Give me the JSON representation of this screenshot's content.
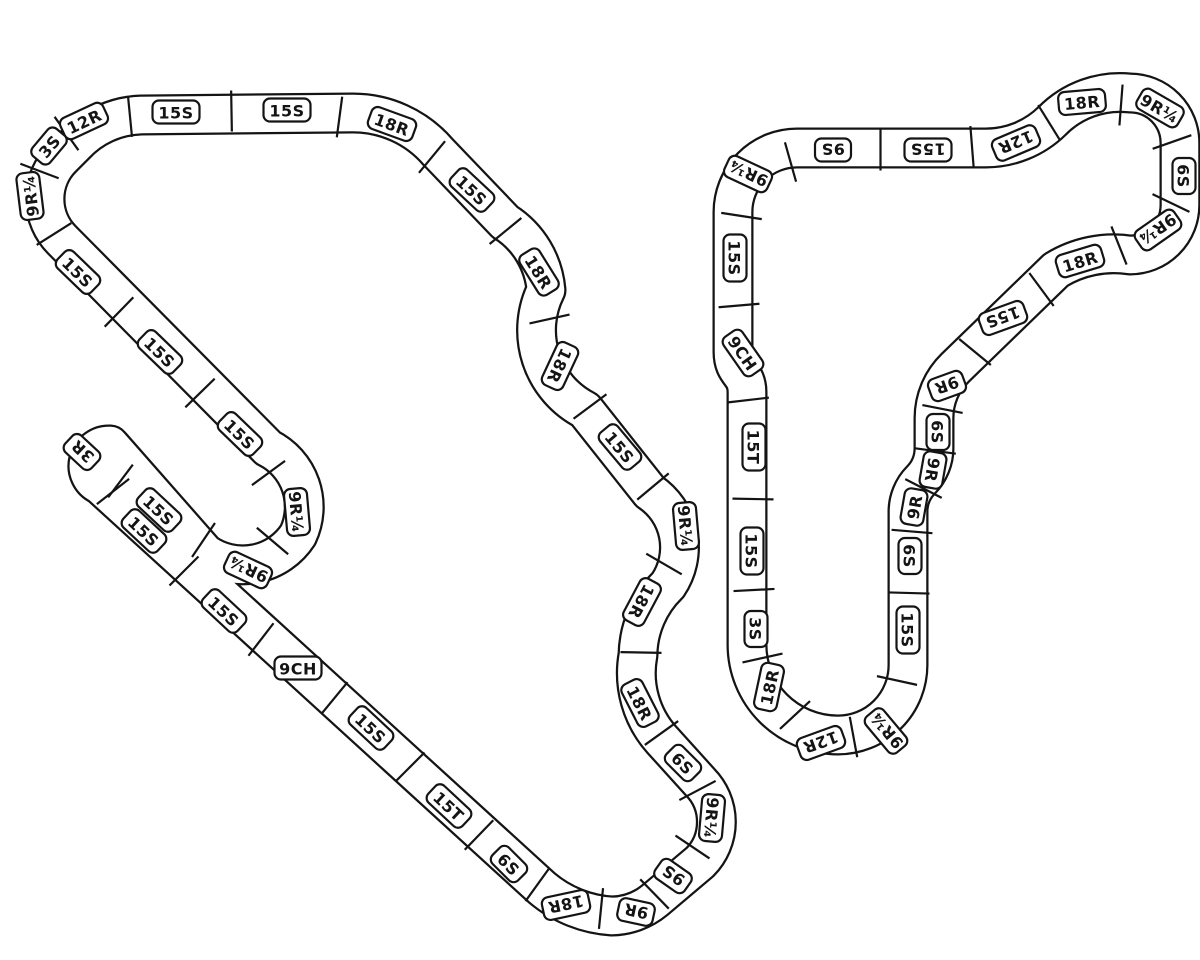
{
  "diagram": {
    "description": "Two HO slot-car track plan circuits built from labeled sectional pieces",
    "colors": {
      "background": "#ffffff",
      "track_fill": "#ffffff",
      "track_outline": "#141414",
      "badge_bg": "#ffffff",
      "badge_border": "#141414",
      "badge_text": "#141414"
    },
    "tracks": [
      {
        "name": "left-circuit",
        "pieces": [
          {
            "label": "12R",
            "x": 84,
            "y": 121,
            "a": -25
          },
          {
            "label": "15S",
            "x": 176,
            "y": 112,
            "a": 0
          },
          {
            "label": "15S",
            "x": 287,
            "y": 110,
            "a": 0
          },
          {
            "label": "18R",
            "x": 392,
            "y": 124,
            "a": 20
          },
          {
            "label": "15S",
            "x": 472,
            "y": 190,
            "a": 43
          },
          {
            "label": "18R",
            "x": 539,
            "y": 272,
            "a": 58
          },
          {
            "label": "18R",
            "x": 560,
            "y": 366,
            "a": 115
          },
          {
            "label": "15S",
            "x": 620,
            "y": 447,
            "a": 50
          },
          {
            "label": "9R¼",
            "x": 686,
            "y": 526,
            "a": 85
          },
          {
            "label": "18R",
            "x": 642,
            "y": 602,
            "a": 118
          },
          {
            "label": "18R",
            "x": 640,
            "y": 703,
            "a": 63
          },
          {
            "label": "6S",
            "x": 683,
            "y": 763,
            "a": 45
          },
          {
            "label": "9R¼",
            "x": 712,
            "y": 818,
            "a": 95
          },
          {
            "label": "9S",
            "x": 673,
            "y": 876,
            "a": 215
          },
          {
            "label": "9R",
            "x": 636,
            "y": 912,
            "a": 192
          },
          {
            "label": "18R",
            "x": 566,
            "y": 905,
            "a": 168
          },
          {
            "label": "6S",
            "x": 509,
            "y": 864,
            "a": 45
          },
          {
            "label": "15T",
            "x": 449,
            "y": 806,
            "a": 43
          },
          {
            "label": "15S",
            "x": 371,
            "y": 728,
            "a": 43
          },
          {
            "label": "9CH",
            "x": 298,
            "y": 668,
            "a": 0
          },
          {
            "label": "15S",
            "x": 224,
            "y": 611,
            "a": 43
          },
          {
            "label": "15S",
            "x": 144,
            "y": 531,
            "a": 43
          },
          {
            "label": "3R",
            "x": 82,
            "y": 452,
            "a": 223
          },
          {
            "label": "15S",
            "x": 159,
            "y": 510,
            "a": 43
          },
          {
            "label": "9R¼",
            "x": 248,
            "y": 570,
            "a": 205
          },
          {
            "label": "9R¼",
            "x": 297,
            "y": 512,
            "a": 85
          },
          {
            "label": "15S",
            "x": 240,
            "y": 434,
            "a": 44
          },
          {
            "label": "15S",
            "x": 160,
            "y": 352,
            "a": 44
          },
          {
            "label": "15S",
            "x": 78,
            "y": 272,
            "a": 44
          },
          {
            "label": "9R¼",
            "x": 30,
            "y": 196,
            "a": -97
          },
          {
            "label": "3S",
            "x": 49,
            "y": 146,
            "a": -50
          }
        ]
      },
      {
        "name": "right-circuit",
        "pieces": [
          {
            "label": "9R¼",
            "x": 748,
            "y": 174,
            "a": 205
          },
          {
            "label": "9S",
            "x": 833,
            "y": 150,
            "a": 180
          },
          {
            "label": "15S",
            "x": 928,
            "y": 150,
            "a": 180
          },
          {
            "label": "12R",
            "x": 1016,
            "y": 143,
            "a": 157
          },
          {
            "label": "18R",
            "x": 1082,
            "y": 102,
            "a": -5
          },
          {
            "label": "9R¼",
            "x": 1160,
            "y": 108,
            "a": 30
          },
          {
            "label": "6S",
            "x": 1184,
            "y": 176,
            "a": 90
          },
          {
            "label": "9R¼",
            "x": 1158,
            "y": 230,
            "a": 145
          },
          {
            "label": "18R",
            "x": 1080,
            "y": 261,
            "a": -17
          },
          {
            "label": "15S",
            "x": 1003,
            "y": 318,
            "a": 160
          },
          {
            "label": "9R",
            "x": 947,
            "y": 386,
            "a": 160
          },
          {
            "label": "6S",
            "x": 938,
            "y": 432,
            "a": 90
          },
          {
            "label": "9R",
            "x": 933,
            "y": 470,
            "a": 100
          },
          {
            "label": "9R",
            "x": 914,
            "y": 507,
            "a": 280
          },
          {
            "label": "6S",
            "x": 910,
            "y": 556,
            "a": 90
          },
          {
            "label": "15S",
            "x": 908,
            "y": 630,
            "a": 90
          },
          {
            "label": "9R¼",
            "x": 886,
            "y": 731,
            "a": 230
          },
          {
            "label": "12R",
            "x": 821,
            "y": 743,
            "a": 160
          },
          {
            "label": "18R",
            "x": 769,
            "y": 687,
            "a": -78
          },
          {
            "label": "3S",
            "x": 756,
            "y": 629,
            "a": 90
          },
          {
            "label": "15S",
            "x": 752,
            "y": 551,
            "a": 90
          },
          {
            "label": "15T",
            "x": 754,
            "y": 447,
            "a": 90
          },
          {
            "label": "9CH",
            "x": 743,
            "y": 353,
            "a": 55
          },
          {
            "label": "15S",
            "x": 735,
            "y": 258,
            "a": 90
          }
        ]
      }
    ]
  }
}
